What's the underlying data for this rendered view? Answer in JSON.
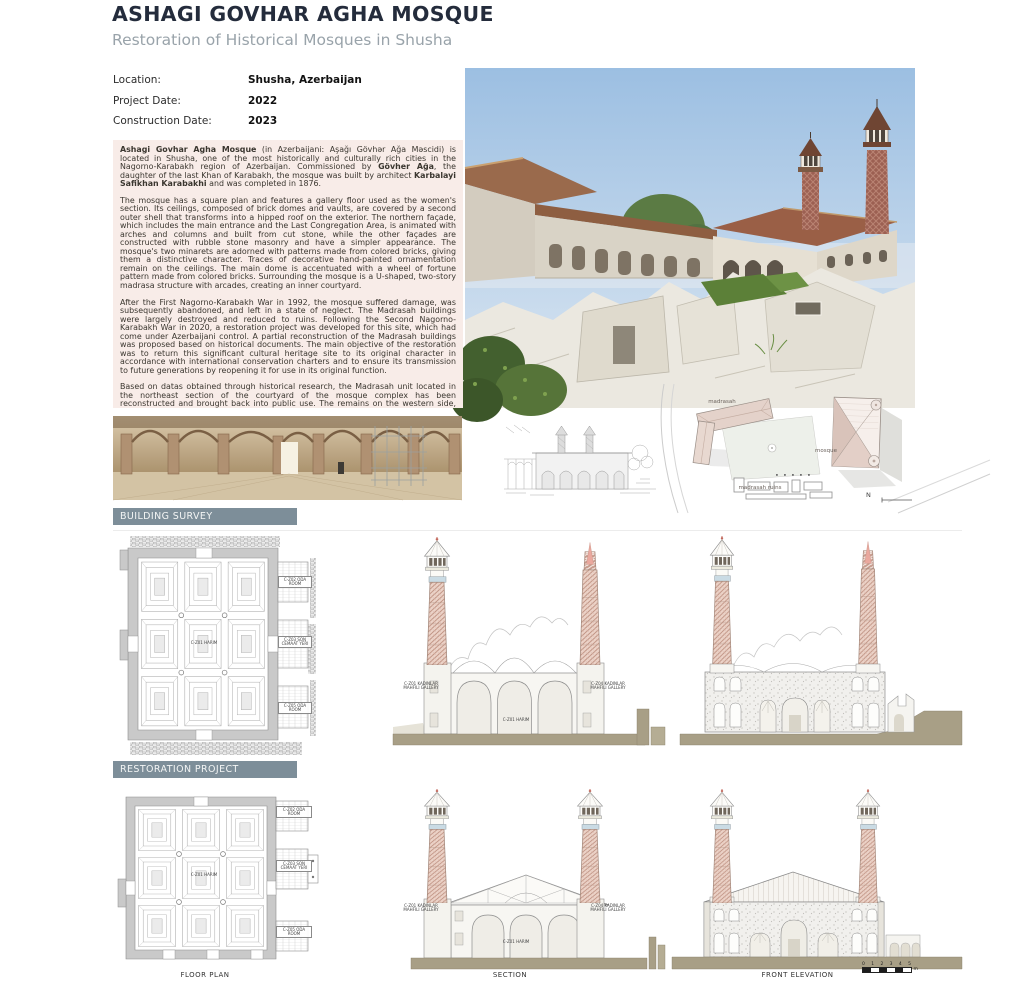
{
  "page": {
    "title": "ASHAGI GOVHAR AGHA MOSQUE",
    "subtitle": "Restoration of Historical Mosques in Shusha"
  },
  "info": {
    "rows": [
      {
        "label": "Location:",
        "value": "Shusha, Azerbaijan"
      },
      {
        "label": "Project Date:",
        "value": "2022"
      },
      {
        "label": "Construction Date:",
        "value": "2023"
      }
    ]
  },
  "description": {
    "paragraphs": [
      {
        "segments": [
          {
            "bold": true,
            "text": "Ashagi Govhar Agha Mosque"
          },
          {
            "bold": false,
            "text": " (in Azerbaijani: Aşağı Gövhər Ağa Məscidi) is located in Shusha, one of the most historically and culturally rich cities in the Nagorno-Karabakh region of Azerbaijan. Commissioned by "
          },
          {
            "bold": true,
            "text": "Gövher Ağa"
          },
          {
            "bold": false,
            "text": ", the daughter of the last Khan of Karabakh, the mosque was built by architect "
          },
          {
            "bold": true,
            "text": "Karbalayi Safikhan Karabakhi"
          },
          {
            "bold": false,
            "text": " and was completed in 1876."
          }
        ]
      },
      {
        "segments": [
          {
            "bold": false,
            "text": "The mosque has a square plan and features a gallery floor used as the women's section. Its ceilings, composed of brick domes and vaults, are covered by a second outer shell that transforms into a hipped roof on the exterior. The northern façade, which includes the main entrance and the Last Congregation Area, is animated with arches and columns and built from cut stone, while the other façades are constructed with rubble stone masonry and have a simpler appearance. The mosque's two minarets are adorned with patterns made from colored bricks, giving them a distinctive character. Traces of decorative hand-painted ornamentation remain on the ceilings. The main dome is accentuated with a wheel of fortune pattern made from colored bricks. Surrounding the mosque is a U-shaped, two-story madrasa structure with arcades, creating an inner courtyard."
          }
        ]
      },
      {
        "segments": [
          {
            "bold": false,
            "text": "After the First Nagorno-Karabakh War in 1992, the mosque suffered damage, was subsequently abandoned, and left in a state of neglect. The Madrasah buildings were largely destroyed and reduced to ruins. Following the Second Nagorno-Karabakh War in 2020, a restoration project was developed for this site, which had come under Azerbaijani control. A partial reconstruction of the Madrasah buildings was proposed based on historical documents. The main objective of the restoration was to return this significant cultural heritage site to its original character in accordance with international conservation charters and to ensure its transmission to future generations by reopening it for use in its original function."
          }
        ]
      },
      {
        "segments": [
          {
            "bold": false,
            "text": "Based on datas obtained through historical research, the Madrasah unit located in the northeast section of the courtyard of the mosque complex has been reconstructed and brought back into public use. The remains on the western side, for which sufficient information regarding their original state could not be determined, have been structurally strenghtened, partially restored, and preserved."
          }
        ]
      }
    ]
  },
  "section_headers": {
    "survey": "BUILDING SURVEY",
    "restoration": "RESTORATION PROJECT"
  },
  "site_plan": {
    "madrasah_label": "madrasah",
    "mosque_label": "mosque",
    "ruins_label": "madrasah ruins",
    "north_label": "N"
  },
  "plan_labels": {
    "harim": "C-Z01 HARIM",
    "room_top": "C-Z02 ODA ROOM",
    "son_cemaat": "C-Z03 SON CEMAAT YERI",
    "room_bottom": "C-Z05 ODA ROOM"
  },
  "section_labels": {
    "gallery_left": "C-Z01 KADINLAR MAHFILI GALLERY",
    "gallery_right": "C-Z04 KADINLAR MAHFILI GALLERY",
    "harim": "C-Z01 HARIM"
  },
  "captions": {
    "floor_plan": "FLOOR PLAN",
    "section": "SECTION",
    "front_elevation": "FRONT ELEVATION"
  },
  "scale_bar": {
    "ticks": [
      "0",
      "1",
      "2",
      "3",
      "4",
      "5"
    ],
    "unit": "m"
  },
  "colors": {
    "title": "#242c3c",
    "subtitle": "#99a3aa",
    "section_bar": "#7d8e99",
    "text_block_bg": "#f8ece8",
    "ground": "#a89f86",
    "brick": "#c09384",
    "roof_pink": "#d9c3ba"
  }
}
